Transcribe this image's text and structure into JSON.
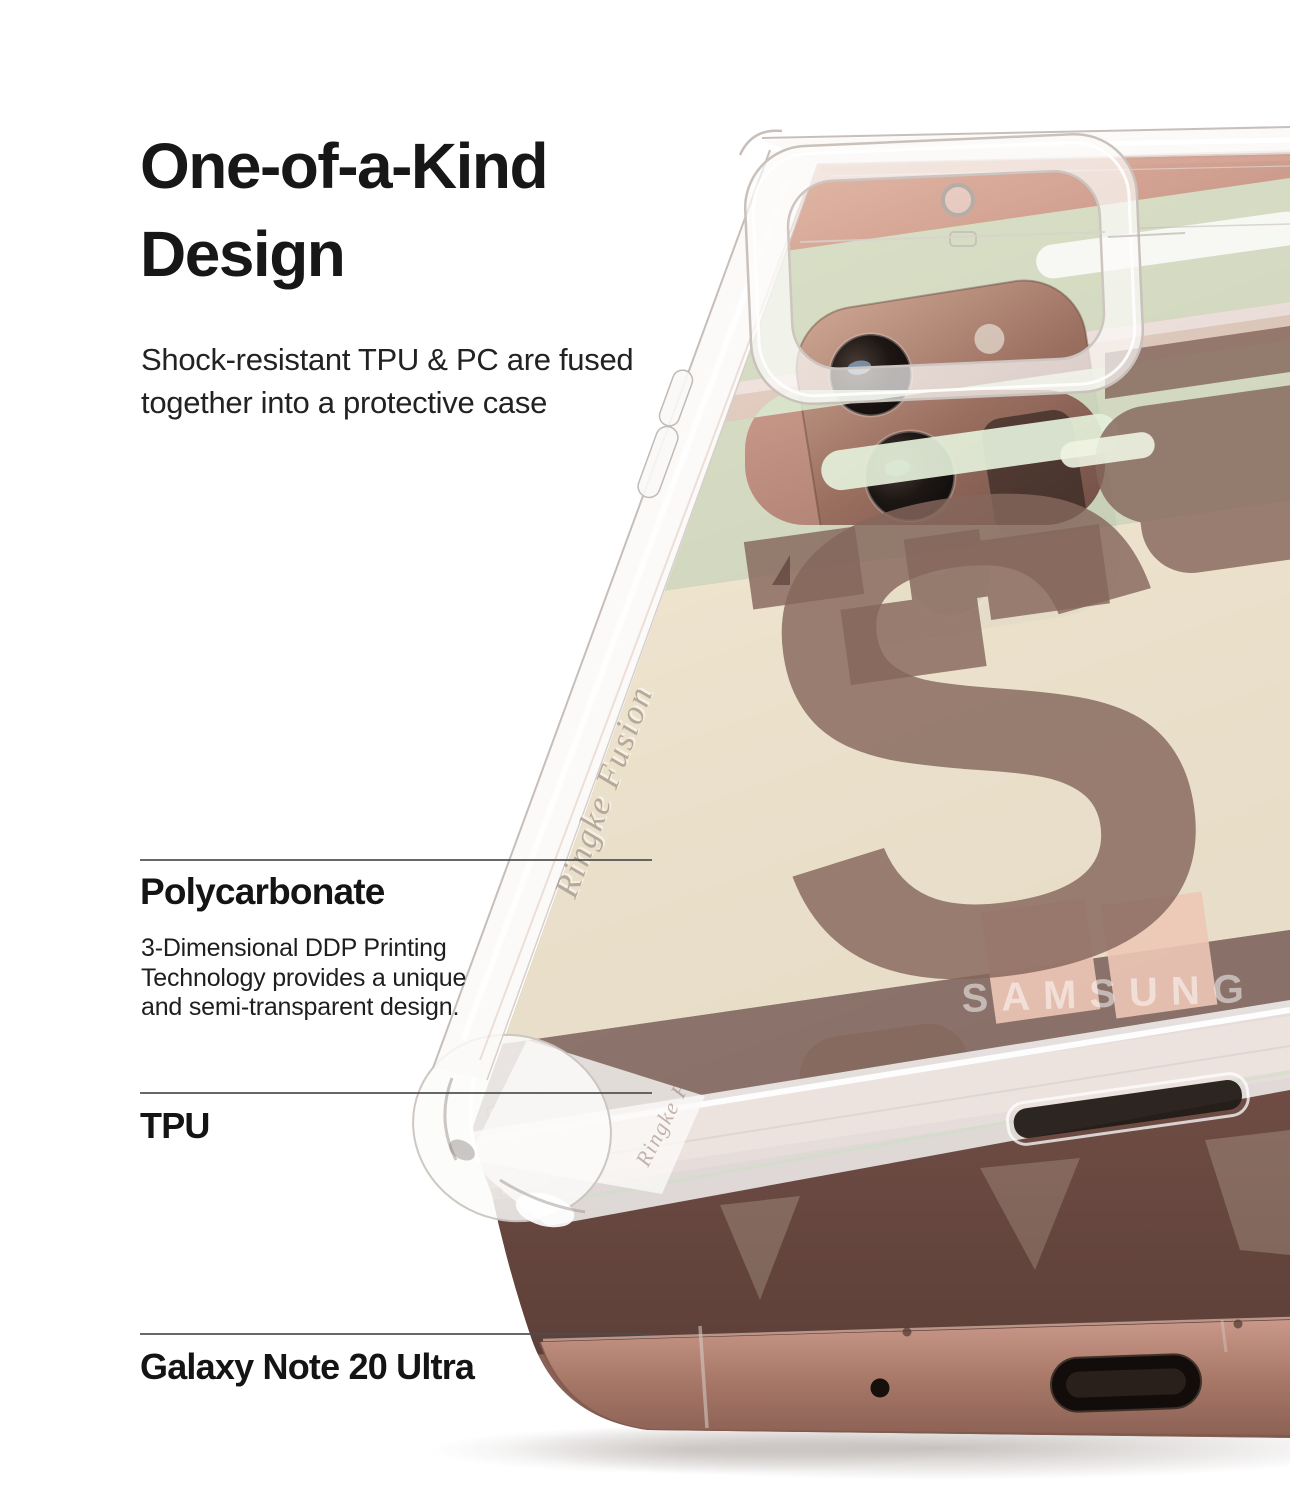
{
  "page": {
    "background": "#ffffff",
    "width": "1290",
    "height": "1500"
  },
  "header": {
    "title_lines": [
      "One-of-a-Kind",
      "Design"
    ],
    "subtitle_lines": [
      "Shock-resistant TPU & PC are fused",
      "together into a protective case"
    ]
  },
  "callouts": [
    {
      "label": "Polycarbonate",
      "description_lines": [
        "3-Dimensional DDP Printing",
        "Technology provides a unique",
        "and semi-transparent design."
      ]
    },
    {
      "label": "TPU"
    },
    {
      "label": "Galaxy Note 20 Ultra"
    }
  ],
  "product": {
    "brand_logo": "SAMSUNG",
    "case_engraving": "Ringke Fusion",
    "pattern_letter": "S",
    "colors": {
      "phone_bronze": "#a87b6e",
      "phone_bronze_dark": "#6b4a42",
      "phone_bronze_light": "#eecbb9",
      "print_mint": "#d7e8cd",
      "print_cream": "#f6f0d9",
      "print_letter_brown": "#85675c",
      "heading_text": "#171717",
      "callout_line": "#4d4d4d"
    }
  }
}
